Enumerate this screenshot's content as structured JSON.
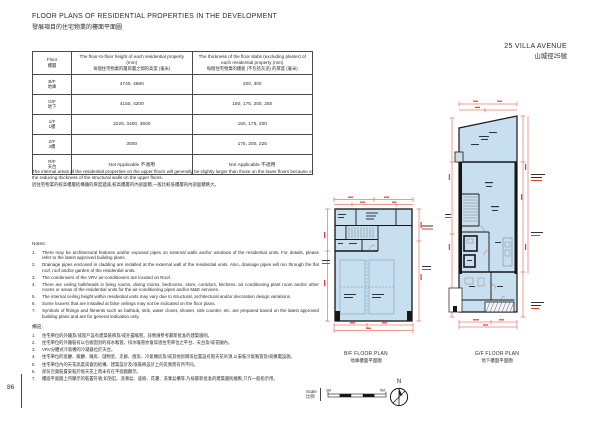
{
  "page_number": "86",
  "header": {
    "title_en": "FLOOR PLANS OF RESIDENTIAL PROPERTIES IN THE DEVELOPMENT",
    "title_zh": "發展項目的住宅物業的樓面平面圖"
  },
  "table": {
    "col1_en": "Floor",
    "col1_zh": "樓層",
    "col2_en": "The floor-to-floor height of each residential property (mm)",
    "col2_zh": "每個住宅物業的層與層之間的高度 (毫米)",
    "col3_en": "The thickness of the floor slabs (excluding plaster) of each residential property (mm)",
    "col3_zh": "每個住宅物業的樓板 (不包括灰泥) 的厚度 (毫米)",
    "rows": [
      {
        "floor_en": "B/F",
        "floor_zh": "地庫",
        "height": "4740, 4680",
        "thickness": "200, 300"
      },
      {
        "floor_en": "G/F",
        "floor_zh": "地下",
        "height": "4150, 4200",
        "thickness": "150, 175, 200, 250"
      },
      {
        "floor_en": "1/F",
        "floor_zh": "1樓",
        "height": "3225, 3400, 3500",
        "thickness": "150, 175, 200"
      },
      {
        "floor_en": "2/F",
        "floor_zh": "2樓",
        "height": "3500",
        "thickness": "175, 200, 225"
      },
      {
        "floor_en": "R/F",
        "floor_zh": "天台",
        "height": "Not Applicable 不適用",
        "thickness": "Not Applicable 不適用"
      }
    ]
  },
  "remark_en": "The internal areas of the residential properties on the upper floors will generally be slightly larger than those on the lower floors because of the reducing thickness of the structural walls on the upper floors.",
  "remark_zh": "因住宅物業的較高樓層結構牆的厚度遞減,較高樓層的內部面積,一般比較低樓層的內部面積略大。",
  "notes": {
    "label_en": "Notes:",
    "en": [
      {
        "n": "1.",
        "t": "There may be architectural features and/or exposed pipes on external walls and/or windows of the residential units. For details, please refer to the latest approved building plans."
      },
      {
        "n": "2.",
        "t": "Drainage pipes enclosed in cladding are installed at the external wall of the residential units. Also, drainage pipes will run through the flat roof, roof and/or garden of the residential units."
      },
      {
        "n": "3.",
        "t": "The condensers of the VRV air-conditioners are located on Roof."
      },
      {
        "n": "4.",
        "t": "There are ceiling bulkheads in living rooms, dining rooms, bedrooms, store, corridors, kitchens, air conditioning plant room and/or other rooms or areas of the residential units for the air-conditioning pipes and/or M&E services."
      },
      {
        "n": "5.",
        "t": "The internal ceiling height within residential units may vary due to structural, architectural and/or decoration design variations."
      },
      {
        "n": "6.",
        "t": "Some louvers that are installed at false ceilings may not be indicated on the floor plans."
      },
      {
        "n": "7.",
        "t": "Symbols of fittings and fitments such as bathtub, sink, water closet, shower, sink counter, etc. are prepared based on the latest approved building plans and are for general indication only."
      }
    ],
    "label_zh": "備註:",
    "zh": [
      {
        "n": "1.",
        "t": "住宅單位的外牆及/或窗戶設有建築裝飾及/或外露喉管。詳情請參考最新批准的建築圖則。"
      },
      {
        "n": "2.",
        "t": "住宅單位的外牆裝有以包板圍封的排水喉管。排水喉管亦會穿過住宅單位之平台、天台及/或花園內。"
      },
      {
        "n": "3.",
        "t": "VRV分體式冷氣機的冷凝器位於天台。"
      },
      {
        "n": "4.",
        "t": "住宅單位的客廳、飯廳、睡房、儲物室、走廊、廚房、冷氣機房及/或其他房間或位置設有假天花吊頂,以安裝冷氣喉管及/或機電設施。"
      },
      {
        "n": "5.",
        "t": "住宅單位內的天花高度或會因結構、建築設計及/或裝飾設計上的差異而有所不同。"
      },
      {
        "n": "6.",
        "t": "部份百葉裝置安裝於假天花上而未有在平面圖顯示。"
      },
      {
        "n": "7.",
        "t": "樓面平面圖上所顯示的裝置符號,如浴缸、洗滌盆、座廁、花灑、洗滌盆櫃等,乃按最新批准的建築圖則繪製,只作一般指示用。"
      }
    ]
  },
  "plans": {
    "address_en": "25 VILLA AVENUE",
    "address_zh": "山城徑25號",
    "bf_caption_en": "B/F FLOOR PLAN",
    "bf_caption_zh": "地庫樓面平面圖",
    "gf_caption_en": "G/F FLOOR PLAN",
    "gf_caption_zh": "地下樓面平面圖"
  },
  "scale": {
    "label_en": "Scale",
    "label_zh": "比例",
    "left": "0M",
    "right": "5M"
  },
  "compass_label": "N",
  "colors": {
    "plan_fill": "#c8dff0",
    "dimension_red": "#e23b2e",
    "wall_black": "#161616"
  }
}
